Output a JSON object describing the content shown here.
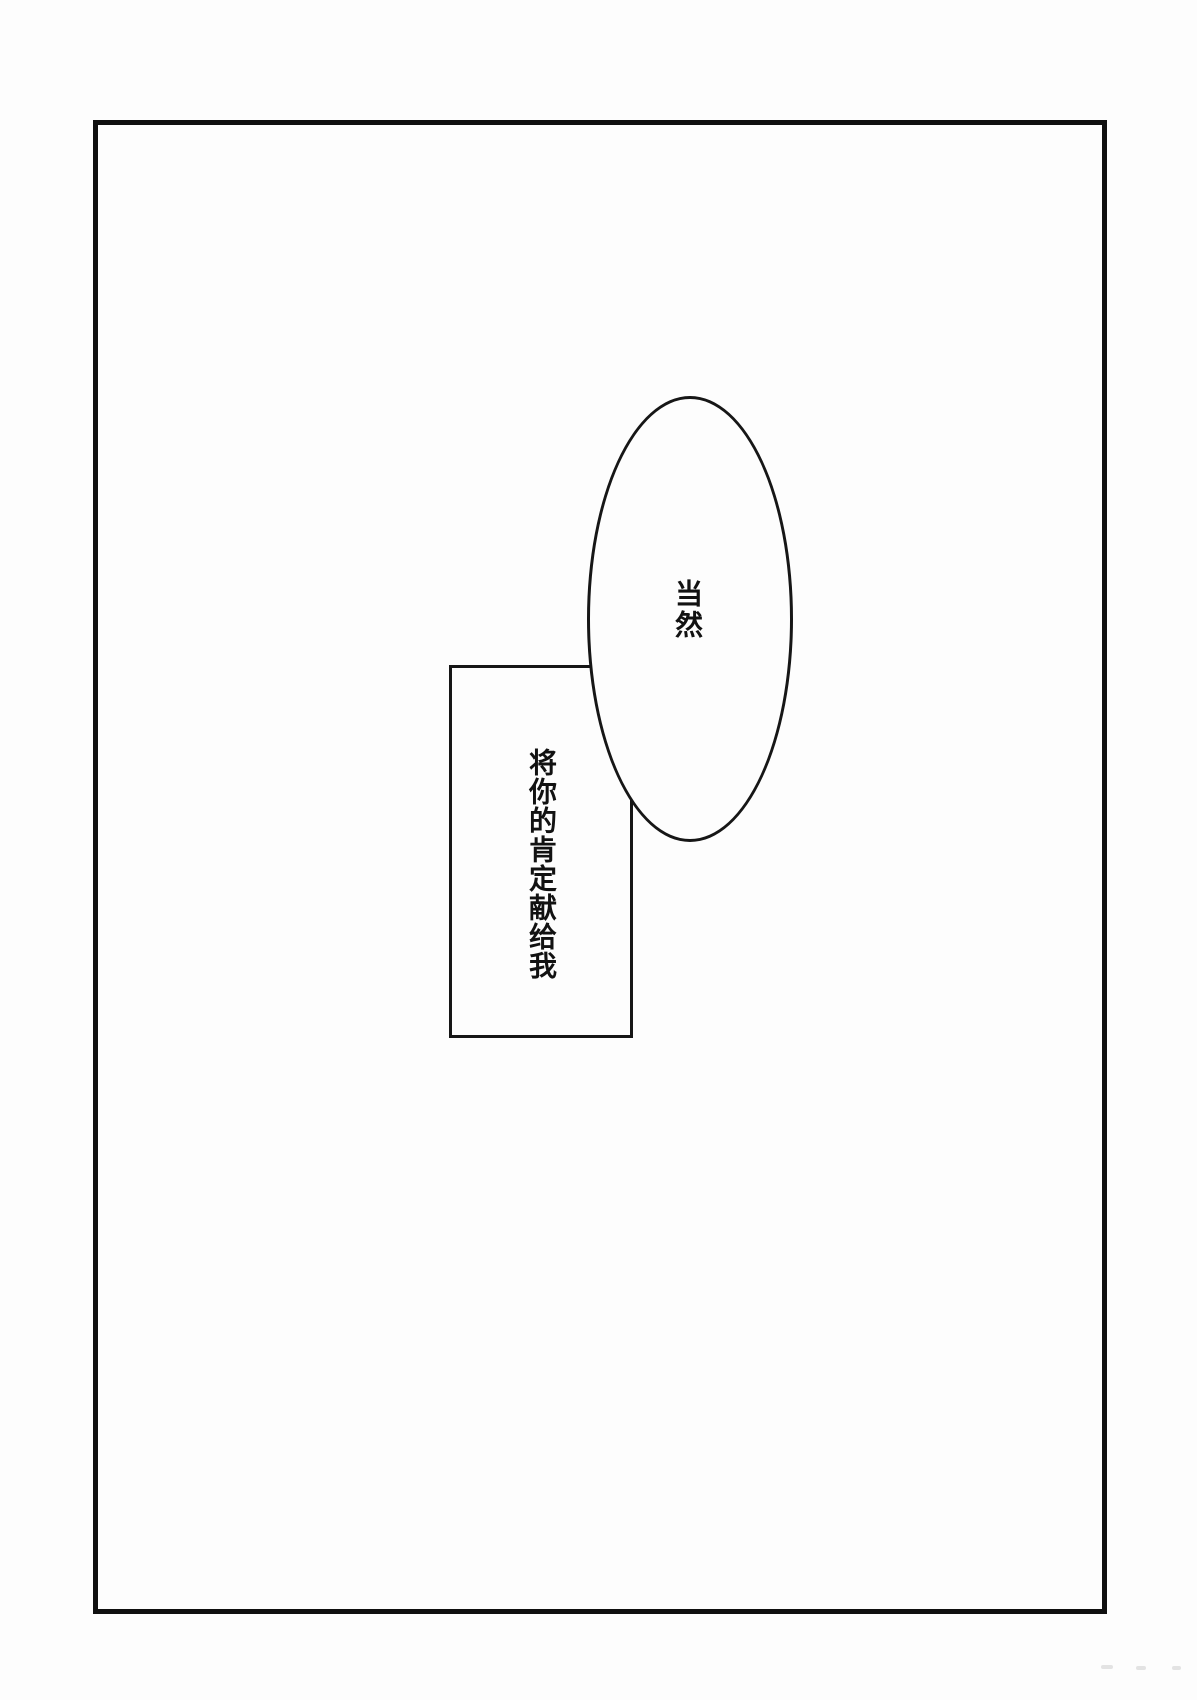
{
  "page": {
    "type": "manga-page",
    "background_color": "#fdfdfd",
    "ink_color": "#121212"
  },
  "bubbles": {
    "ellipse": {
      "shape": "ellipse",
      "text": "当然",
      "writing_direction": "vertical"
    },
    "box": {
      "shape": "rectangle",
      "text": "将你的肯定献给我",
      "writing_direction": "vertical"
    }
  }
}
